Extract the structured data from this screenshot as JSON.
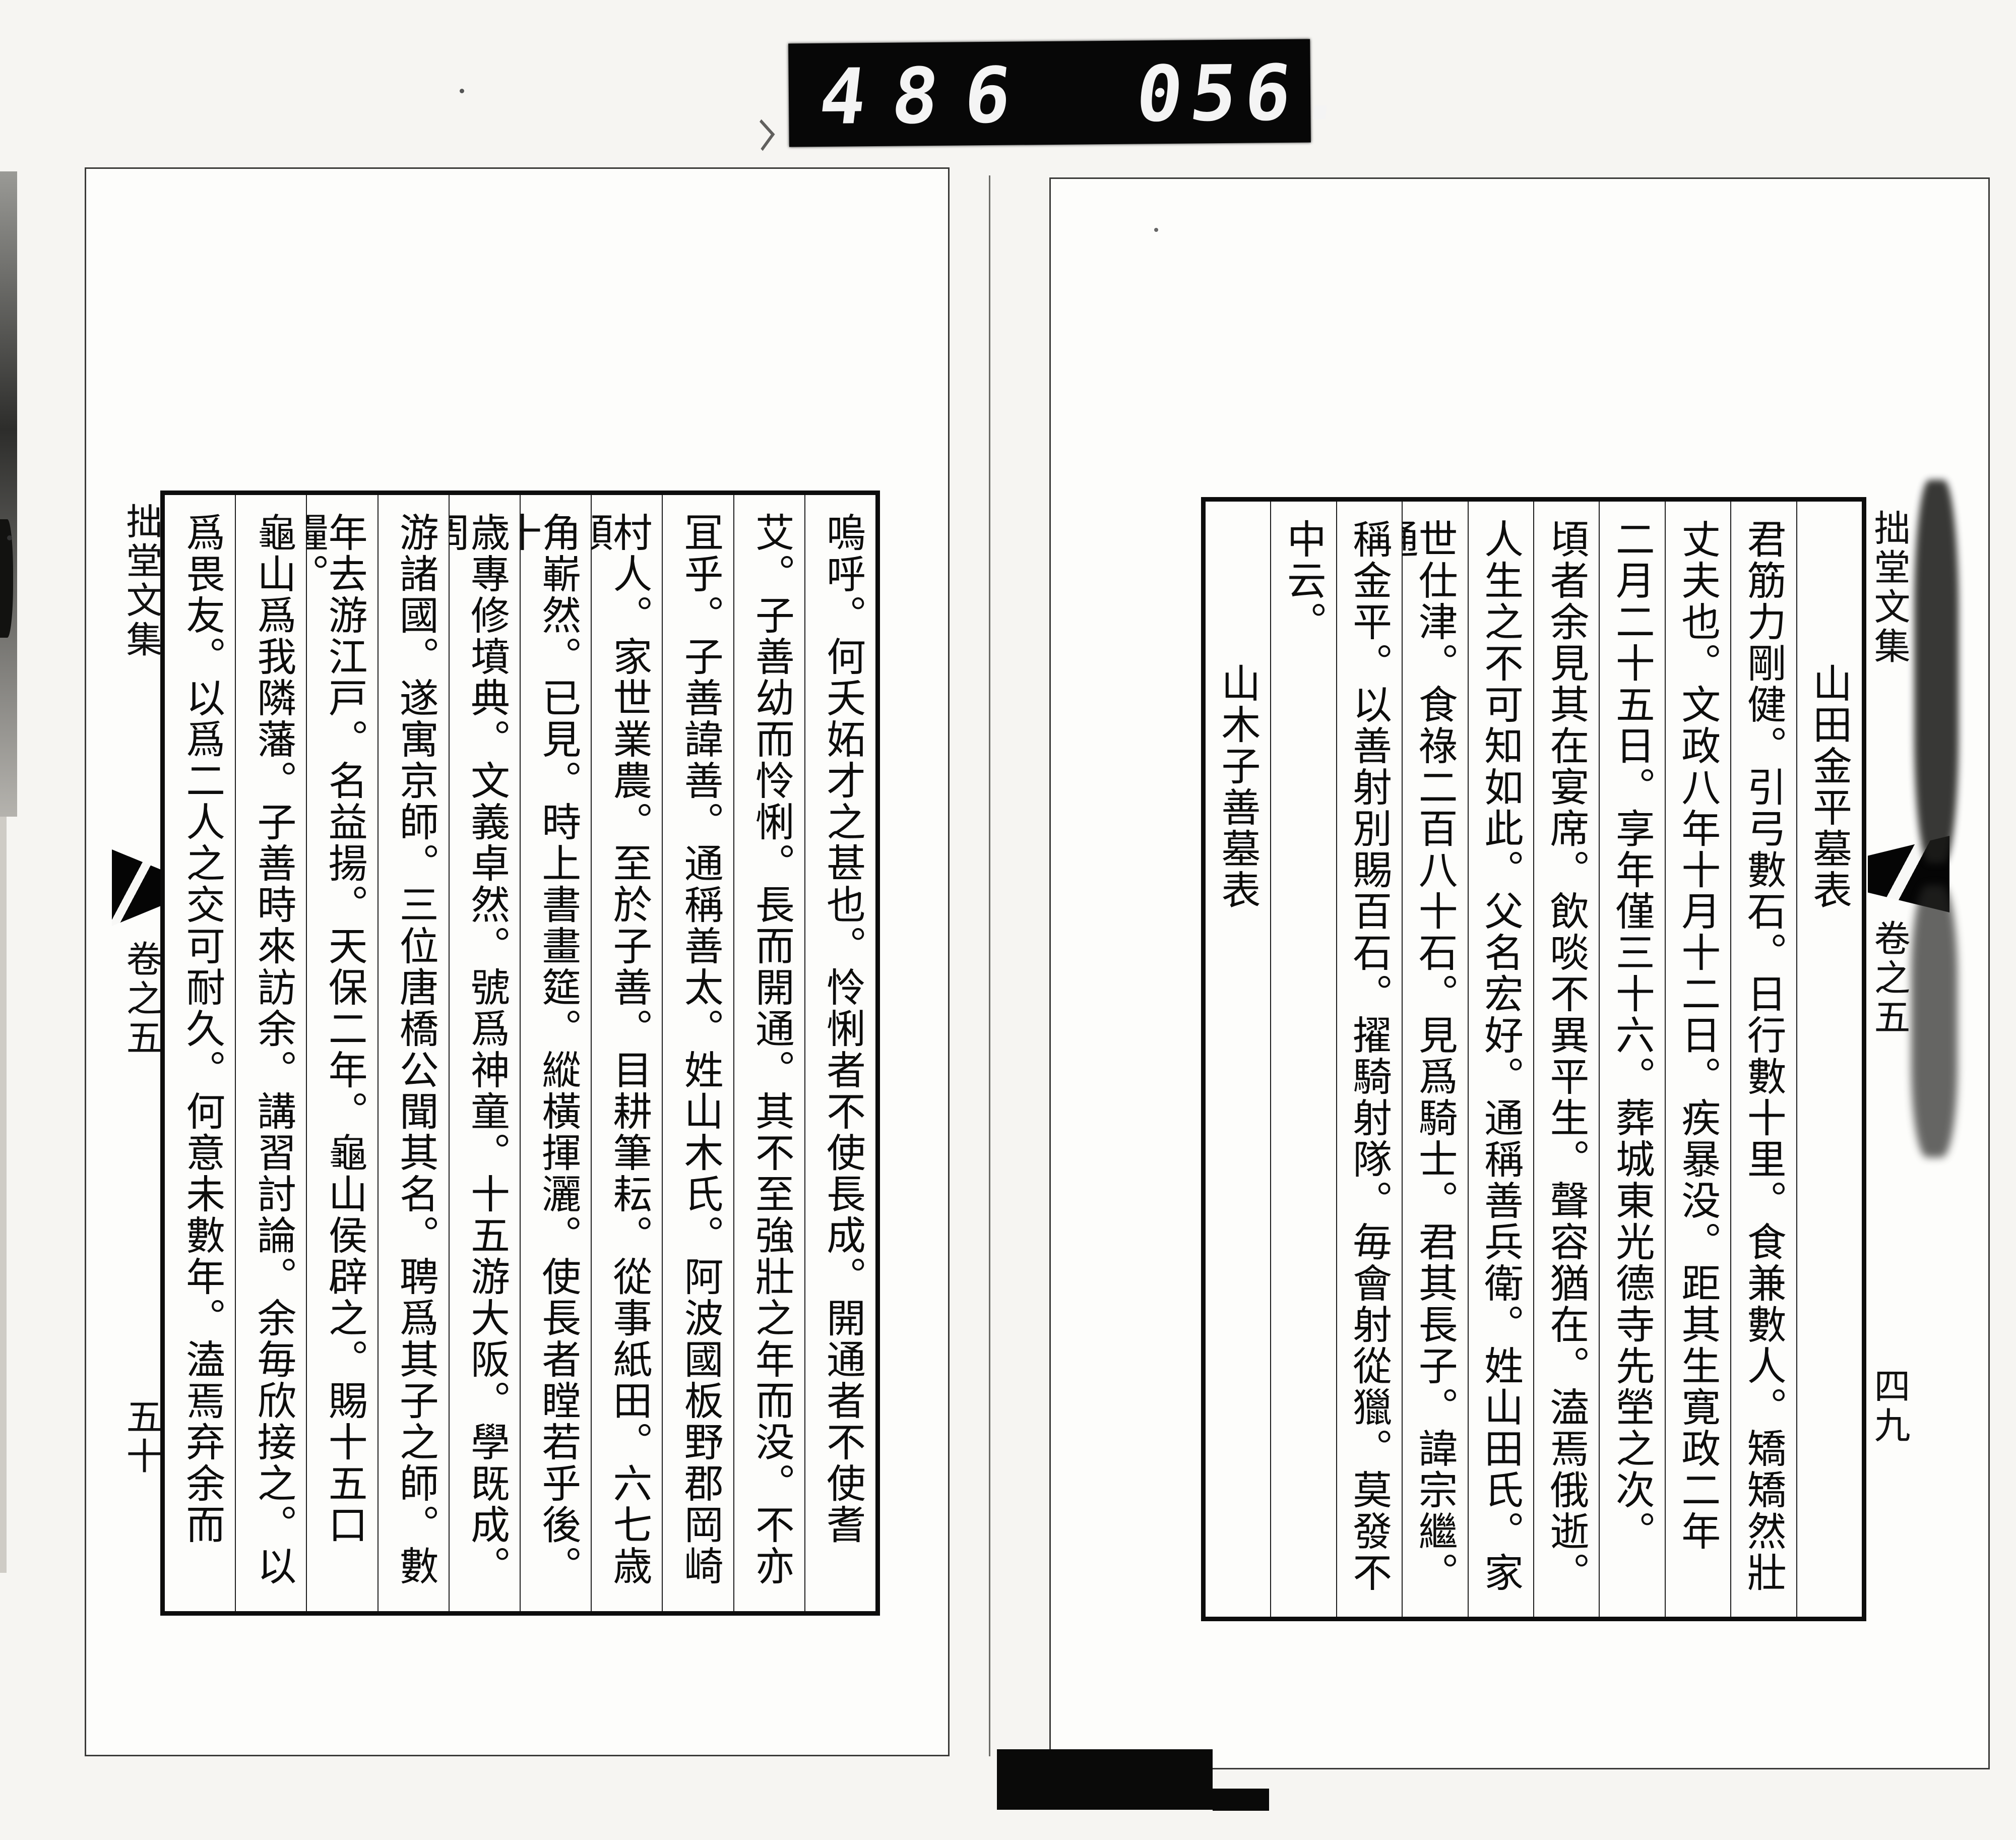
{
  "counter": {
    "group_left": "486",
    "group_right": "056."
  },
  "book": {
    "right_page": {
      "hanshin": {
        "title": "拙堂文集",
        "volume": "卷之五",
        "folio": "四九"
      },
      "columns": [
        {
          "type": "title",
          "text": "山田金平墓表"
        },
        {
          "type": "body",
          "text": "君筋力剛健。引弓數石。日行數十里。食兼數人。矯矯然壯"
        },
        {
          "type": "body",
          "text": "丈夫也。文政八年十月十二日。疾暴没。距其生寛政二年"
        },
        {
          "type": "body",
          "text": "二月二十五日。享年僅三十六。葬城東光德寺先塋之次。"
        },
        {
          "type": "body",
          "text": "頃者余見其在宴席。飲啖不異平生。聲容猶在。溘焉俄逝。"
        },
        {
          "type": "body",
          "text": "人生之不可知如此。父名宏好。通稱善兵衛。姓山田氏。家"
        },
        {
          "type": "body",
          "text": "世仕津。食祿二百八十石。見爲騎士。君其長子。諱宗繼。通"
        },
        {
          "type": "body",
          "text": "稱金平。以善射別賜百石。擢騎射隊。毎會射從獵。莫發不"
        },
        {
          "type": "body",
          "text": "中云。"
        },
        {
          "type": "title",
          "text": "山木子善墓表"
        }
      ]
    },
    "left_page": {
      "hanshin": {
        "title": "拙堂文集",
        "volume": "卷之五",
        "folio": "五十"
      },
      "columns": [
        {
          "type": "body",
          "text": "嗚呼。何夭妬才之甚也。怜悧者不使長成。開通者不使耆"
        },
        {
          "type": "body",
          "text": "艾。子善幼而怜悧。長而開通。其不至強壯之年而没。不亦"
        },
        {
          "type": "body",
          "text": "冝乎。子善諱善。通稱善太。姓山木氏。阿波國板野郡岡崎"
        },
        {
          "type": "body",
          "text": "村人。家世業農。至於子善。目耕筆耘。從事紙田。六七歳頭"
        },
        {
          "type": "body",
          "text": "角嶄然。已見。時上書畫筵。縱橫揮灑。使長者瞠若乎後。十"
        },
        {
          "type": "body",
          "text": "歳專修墳典。文義卓然。號爲神童。十五游大阪。學既成。周"
        },
        {
          "type": "body",
          "text": "游諸國。遂寓京師。三位唐橋公聞其名。聘爲其子之師。數"
        },
        {
          "type": "body",
          "text": "年去游江戸。名益揚。天保二年。龜山侯辟之。賜十五口糧。"
        },
        {
          "type": "body",
          "text": "龜山爲我隣藩。子善時來訪余。講習討論。余毎欣接之。以"
        },
        {
          "type": "body",
          "text": "爲畏友。以爲二人之交可耐久。何意未數年。溘焉弃余而"
        }
      ]
    }
  }
}
